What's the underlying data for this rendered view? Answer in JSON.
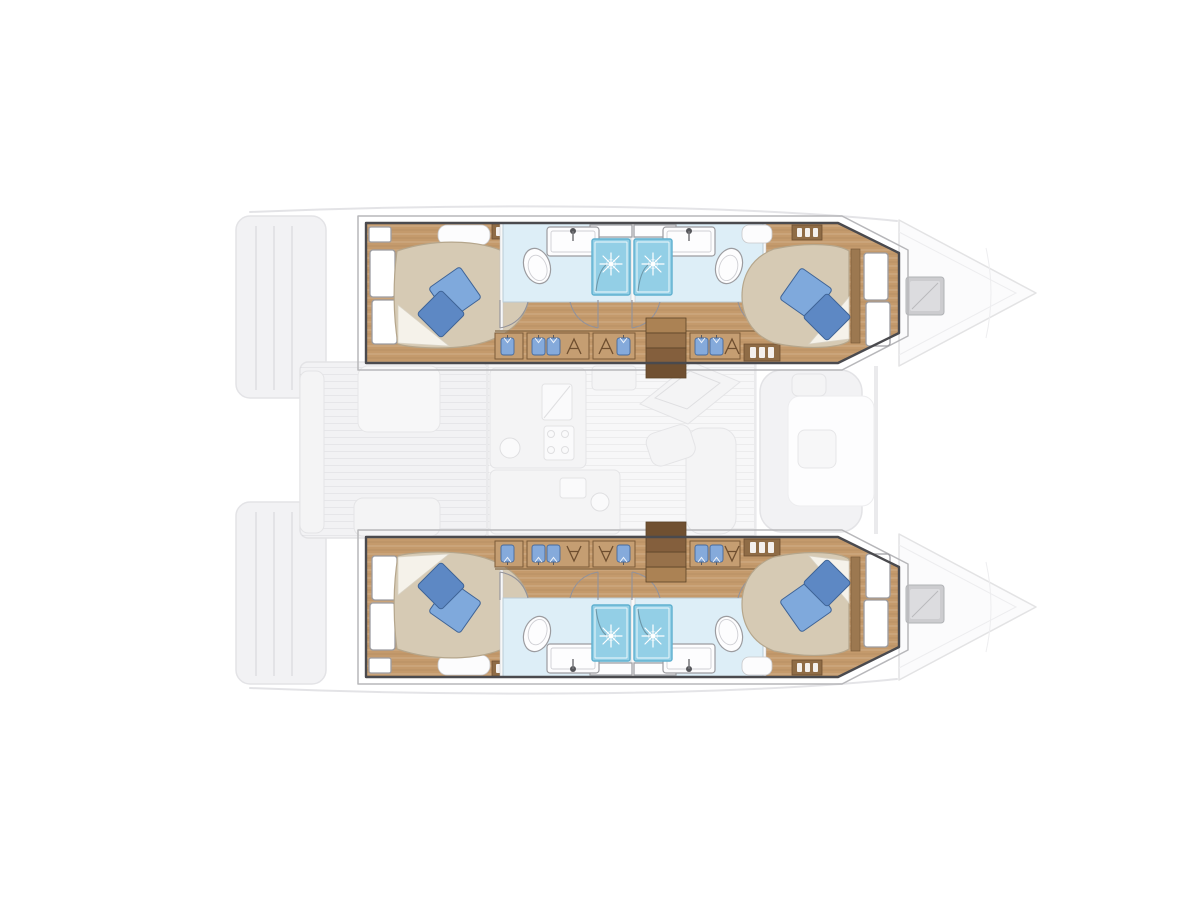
{
  "page": {
    "background": "#ffffff",
    "description": "Overhead interior layout plan of a sailing catamaran; twin hull interiors highlighted in colour, deck, saloon, cockpits and bows shown ghosted in light grey"
  },
  "colors": {
    "page_bg": "#ffffff",
    "hull_outline": "#4a4a4e",
    "shell_line": "#b7b7ba",
    "wood_floor": "#c49a6c",
    "wood_trim": "#8f6c46",
    "wood_dark": "#6f4f30",
    "bed_linen": "#d6cab4",
    "bed_edge": "#b5a68c",
    "sheet_white": "#f5f2ea",
    "pillow_blue": "#7fa9dc",
    "pillow_blue_dark": "#5d88c4",
    "pillow_outline": "#3e6396",
    "bathroom_floor": "#ddeef7",
    "fixture_white": "#fdfdfe",
    "fixture_outline": "#9c9ca0",
    "shower_cyan": "#93cfe6",
    "shower_border": "#5fb0cf",
    "wardrobe_blue": "#85aadb",
    "ghost_fill": "#f1f1f3",
    "ghost_line": "#e1e1e4",
    "hatch_gray": "#c7c7ca"
  },
  "plan": {
    "vessel_type": "catamaran",
    "view": "top-down deck plan, bows pointing right",
    "counts": {
      "cabins": 4,
      "double_berths": 4,
      "bathrooms": 4,
      "shower_cubicles": 4,
      "deck_hatches": 2
    },
    "hulls": [
      {
        "name": "port hull (top)",
        "rooms": [
          {
            "name": "aft double cabin",
            "features": [
              "island double berth",
              "beige bedding with white sheet",
              "two blue pillows",
              "hull windows"
            ]
          },
          {
            "name": "aft bathroom",
            "features": [
              "toilet",
              "washbasin with faucet",
              "shower cubicle with rain head"
            ]
          },
          {
            "name": "forward bathroom",
            "features": [
              "toilet",
              "washbasin with faucet",
              "shower cubicle with rain head"
            ]
          },
          {
            "name": "forward double cabin",
            "features": [
              "island double berth",
              "beige bedding with white sheet",
              "two blue pillows",
              "headboard",
              "hull windows"
            ]
          },
          {
            "name": "companionway corridor",
            "features": [
              "wardrobes with hanging clothes",
              "storage lockers",
              "staircase down from saloon",
              "vent grille"
            ]
          }
        ]
      },
      {
        "name": "starboard hull (bottom)",
        "rooms": [
          {
            "name": "aft double cabin",
            "features": [
              "island double berth",
              "beige bedding with white sheet",
              "two blue pillows",
              "hull windows"
            ]
          },
          {
            "name": "aft bathroom",
            "features": [
              "toilet",
              "washbasin with faucet",
              "shower cubicle with rain head"
            ]
          },
          {
            "name": "forward bathroom",
            "features": [
              "toilet",
              "washbasin with faucet",
              "shower cubicle with rain head"
            ]
          },
          {
            "name": "forward double cabin",
            "features": [
              "island double berth",
              "beige bedding with white sheet",
              "two blue pillows",
              "headboard",
              "hull windows"
            ]
          },
          {
            "name": "companionway corridor",
            "features": [
              "wardrobes with hanging clothes",
              "storage lockers",
              "staircase down from saloon",
              "vent grille"
            ]
          }
        ]
      }
    ],
    "ghosted_areas": [
      {
        "name": "transom steps",
        "position": "aft, left edge"
      },
      {
        "name": "aft cockpit",
        "features": [
          "teak floor",
          "side bench",
          "cockpit table",
          "aft seat"
        ]
      },
      {
        "name": "saloon and galley",
        "features": [
          "galley counters",
          "sink",
          "stove",
          "refrigerator",
          "navigation station",
          "sofa"
        ]
      },
      {
        "name": "forward cockpit",
        "features": [
          "U-shaped seating",
          "small table"
        ]
      },
      {
        "name": "bow sections",
        "features": [
          "deck hatch",
          "hull taper to stem"
        ]
      }
    ]
  }
}
